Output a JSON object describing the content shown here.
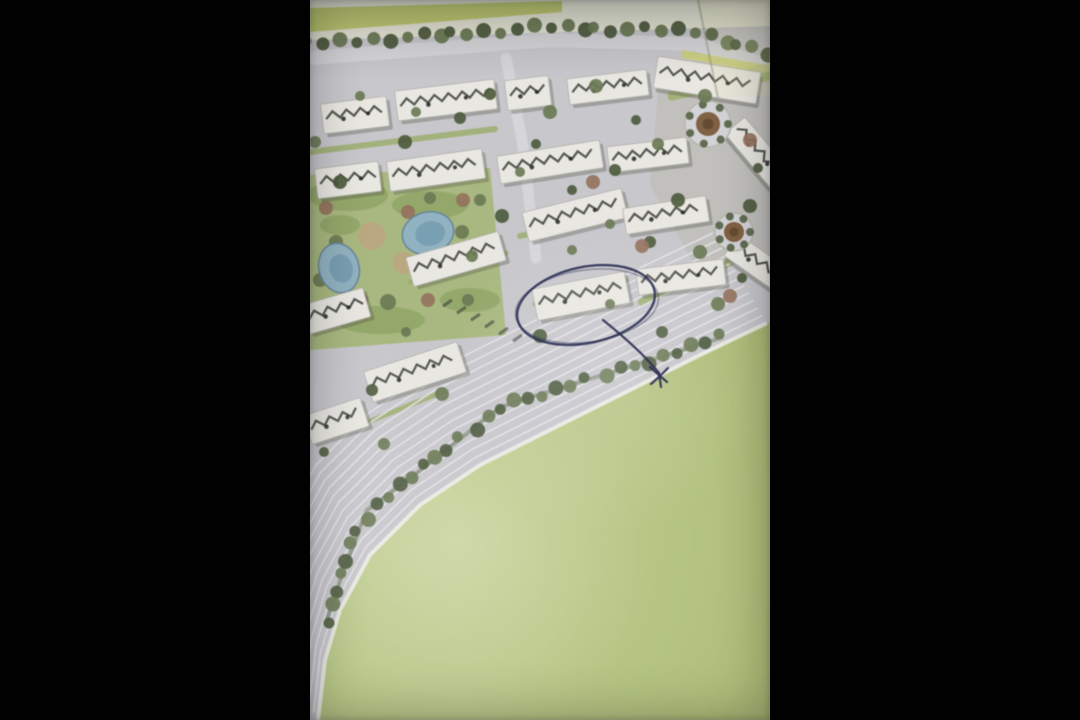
{
  "frame": {
    "width": 1080,
    "height": 720,
    "strip_left": 310,
    "strip_width": 460
  },
  "colors": {
    "letterbox": "#010101",
    "road_base": "#c9c8ce",
    "road_light": "#d8d7dc",
    "stripe": "#e7e6ea",
    "curb": "#efeee9",
    "page_light": "#e9ead9",
    "grass": "#c1ce6d",
    "yellow_strip": "#d0d26d",
    "tree_dark": "#4c5b3b",
    "tree_mid": "#697951",
    "hedge": "#5a6847",
    "building_fill": "#ebe9e3",
    "building_edge": "#b2b1ab",
    "building_shadow": "#545748",
    "roof_mark": "#23261e",
    "lawn": "#a5b873",
    "lawn_dark": "#8da45f",
    "lawn_strip": "#9cb069",
    "sand": "#c0a67e",
    "autumn": "#96705a",
    "pool_fill": "#8fb3c4",
    "pool_deep": "#6f9ab0",
    "pool_edge": "#64869d",
    "field_light": "#ccd89e",
    "field": "#b8c881",
    "field_dark": "#a8ba6c",
    "plaza": "#b2b399",
    "roundabout_ring": "#d6d5da",
    "roundabout_center": "#81603f",
    "roundabout_core": "#5f452c",
    "car": "#3a3e33",
    "crease": "#8c8c78",
    "pen": "#2c3158"
  },
  "plan": {
    "top_light": [
      [
        0,
        0
      ],
      [
        460,
        0
      ],
      [
        460,
        26
      ],
      [
        0,
        40
      ]
    ],
    "grass_band": [
      [
        0,
        8
      ],
      [
        252,
        1
      ],
      [
        252,
        12
      ],
      [
        0,
        32
      ]
    ],
    "top_road": {
      "pts": [
        [
          0,
          58
        ],
        [
          240,
          40
        ],
        [
          385,
          44
        ],
        [
          460,
          66
        ]
      ],
      "w": 14
    },
    "side_road": {
      "pts": [
        [
          196,
          58
        ],
        [
          212,
          140
        ],
        [
          226,
          258
        ]
      ],
      "w": 11
    },
    "yellow_strip": {
      "pts": [
        [
          372,
          54
        ],
        [
          460,
          70
        ]
      ],
      "w": 8
    },
    "plaza_tint": [
      [
        348,
        92
      ],
      [
        460,
        62
      ],
      [
        460,
        258
      ],
      [
        386,
        268
      ],
      [
        340,
        185
      ]
    ],
    "crease": [
      [
        388,
        0
      ],
      [
        408,
        98
      ]
    ],
    "corner_tint": [
      [
        388,
        0
      ],
      [
        460,
        0
      ],
      [
        460,
        95
      ],
      [
        408,
        98
      ]
    ],
    "tree_lines": [
      {
        "pts": [
          [
            0,
            44
          ],
          [
            240,
            27
          ],
          [
            385,
            31
          ],
          [
            460,
            54
          ]
        ],
        "n": 30,
        "r": 6.5,
        "underline": false
      },
      {
        "pts": [
          [
            413,
            337
          ],
          [
            373,
            350
          ],
          [
            190,
            407
          ],
          [
            107,
            473
          ],
          [
            57,
            510
          ],
          [
            30,
            580
          ],
          [
            17,
            620
          ]
        ],
        "n": 34,
        "r": 6.5,
        "underline": true
      }
    ],
    "park": {
      "outline": [
        [
          0,
          175
        ],
        [
          180,
          168
        ],
        [
          196,
          335
        ],
        [
          0,
          350
        ]
      ],
      "lawns": [
        [
          38,
          195,
          40,
          16
        ],
        [
          120,
          205,
          38,
          14
        ],
        [
          70,
          320,
          45,
          14
        ],
        [
          160,
          300,
          30,
          12
        ],
        [
          30,
          225,
          20,
          10
        ]
      ],
      "sand": [
        [
          62,
          236,
          14
        ],
        [
          94,
          263,
          11
        ],
        [
          34,
          308,
          10
        ]
      ],
      "autumn": [
        [
          50,
          300,
          8
        ],
        [
          98,
          212,
          7
        ],
        [
          140,
          262,
          8
        ],
        [
          16,
          208,
          7
        ],
        [
          118,
          300,
          7
        ]
      ],
      "bushes": [
        [
          26,
          242,
          7
        ],
        [
          78,
          302,
          8
        ],
        [
          152,
          232,
          7
        ],
        [
          10,
          280,
          7
        ],
        [
          170,
          200,
          6
        ]
      ]
    },
    "pools": [
      {
        "cx": 29,
        "cy": 268,
        "rx": 20,
        "ry": 25,
        "rot": -15
      },
      {
        "cx": 118,
        "cy": 233,
        "rx": 26,
        "ry": 21,
        "rot": -15
      }
    ],
    "lawn_strips": [
      {
        "pts": [
          [
            0,
            152
          ],
          [
            185,
            129
          ]
        ],
        "w": 6
      },
      {
        "pts": [
          [
            210,
            236
          ],
          [
            345,
            206
          ]
        ],
        "w": 6
      },
      {
        "pts": [
          [
            100,
            282
          ],
          [
            196,
            253
          ]
        ],
        "w": 5
      },
      {
        "pts": [
          [
            225,
            304
          ],
          [
            316,
            280
          ]
        ],
        "w": 5
      },
      {
        "pts": [
          [
            332,
            302
          ],
          [
            420,
            262
          ]
        ],
        "w": 8
      },
      {
        "pts": [
          [
            58,
            422
          ],
          [
            132,
            392
          ]
        ],
        "w": 5
      },
      {
        "pts": [
          [
            362,
            96
          ],
          [
            460,
            76
          ]
        ],
        "w": 9
      }
    ],
    "field_edge": [
      [
        457,
        323
      ],
      [
        390,
        355
      ],
      [
        330,
        385
      ],
      [
        250,
        425
      ],
      [
        170,
        465
      ],
      [
        110,
        505
      ],
      [
        60,
        555
      ],
      [
        30,
        610
      ],
      [
        15,
        660
      ],
      [
        8,
        720
      ]
    ],
    "road_stripes": {
      "count": 12,
      "dx": -4.5,
      "dy": -7.5
    },
    "parking_cars": [
      [
        132,
        305
      ],
      [
        146,
        312
      ],
      [
        160,
        319
      ],
      [
        174,
        326
      ],
      [
        188,
        333
      ],
      [
        202,
        340
      ]
    ],
    "buildings": [
      [
        12,
        100,
        66,
        30,
        -7
      ],
      [
        86,
        85,
        100,
        30,
        -7
      ],
      [
        196,
        78,
        44,
        30,
        -7
      ],
      [
        258,
        74,
        80,
        26,
        -7
      ],
      [
        345,
        64,
        104,
        32,
        9
      ],
      [
        6,
        165,
        64,
        30,
        -7
      ],
      [
        78,
        155,
        96,
        30,
        -8
      ],
      [
        188,
        148,
        104,
        28,
        -9
      ],
      [
        298,
        142,
        80,
        26,
        -7
      ],
      [
        412,
        140,
        72,
        26,
        50
      ],
      [
        214,
        200,
        102,
        30,
        -14
      ],
      [
        314,
        202,
        84,
        26,
        -9
      ],
      [
        415,
        252,
        70,
        26,
        35
      ],
      [
        98,
        244,
        96,
        30,
        -16
      ],
      [
        224,
        280,
        94,
        32,
        -11
      ],
      [
        327,
        264,
        88,
        26,
        -7
      ],
      [
        -6,
        296,
        64,
        30,
        -16
      ],
      [
        56,
        356,
        98,
        32,
        -18
      ],
      [
        -4,
        406,
        60,
        30,
        -18
      ]
    ],
    "roundabouts": [
      {
        "cx": 398,
        "cy": 124,
        "r": 23,
        "ir": 12
      },
      {
        "cx": 424,
        "cy": 232,
        "r": 19,
        "ir": 10
      }
    ],
    "trees": [
      [
        50,
        96
      ],
      [
        150,
        118
      ],
      [
        240,
        112
      ],
      [
        326,
        120
      ],
      [
        5,
        142
      ],
      [
        95,
        142
      ],
      [
        210,
        172
      ],
      [
        305,
        170
      ],
      [
        395,
        96
      ],
      [
        448,
        168
      ],
      [
        120,
        198
      ],
      [
        192,
        216
      ],
      [
        262,
        250
      ],
      [
        340,
        242
      ],
      [
        390,
        252
      ],
      [
        432,
        278
      ],
      [
        158,
        300
      ],
      [
        230,
        336
      ],
      [
        96,
        332
      ],
      [
        62,
        390
      ],
      [
        132,
        394
      ],
      [
        14,
        452
      ],
      [
        74,
        444
      ],
      [
        368,
        200
      ],
      [
        300,
        304
      ],
      [
        352,
        332
      ],
      [
        408,
        304
      ],
      [
        262,
        190
      ],
      [
        162,
        256
      ],
      [
        30,
        182
      ],
      [
        106,
        112
      ],
      [
        180,
        94
      ],
      [
        286,
        86
      ],
      [
        226,
        144
      ],
      [
        348,
        144
      ],
      [
        440,
        206
      ],
      [
        300,
        224
      ]
    ],
    "autumn_trees": [
      [
        153,
        200
      ],
      [
        283,
        182
      ],
      [
        440,
        140
      ],
      [
        420,
        296
      ],
      [
        332,
        246
      ]
    ]
  },
  "annotation": {
    "ellipse": {
      "cx": 276,
      "cy": 305,
      "rx": 70,
      "ry": 38,
      "rot": -12
    },
    "ellipse_echo": {
      "cx": 277,
      "cy": 306,
      "rx": 72,
      "ry": 36,
      "rot": -8
    },
    "arrow_path": "M 293 320 C 318 340 336 357 349 373",
    "head": [
      [
        350,
        376,
        340,
        367
      ],
      [
        350,
        376,
        358,
        368
      ],
      [
        350,
        376,
        341,
        384
      ],
      [
        350,
        376,
        357,
        382
      ],
      [
        349,
        373,
        351,
        387
      ]
    ]
  }
}
